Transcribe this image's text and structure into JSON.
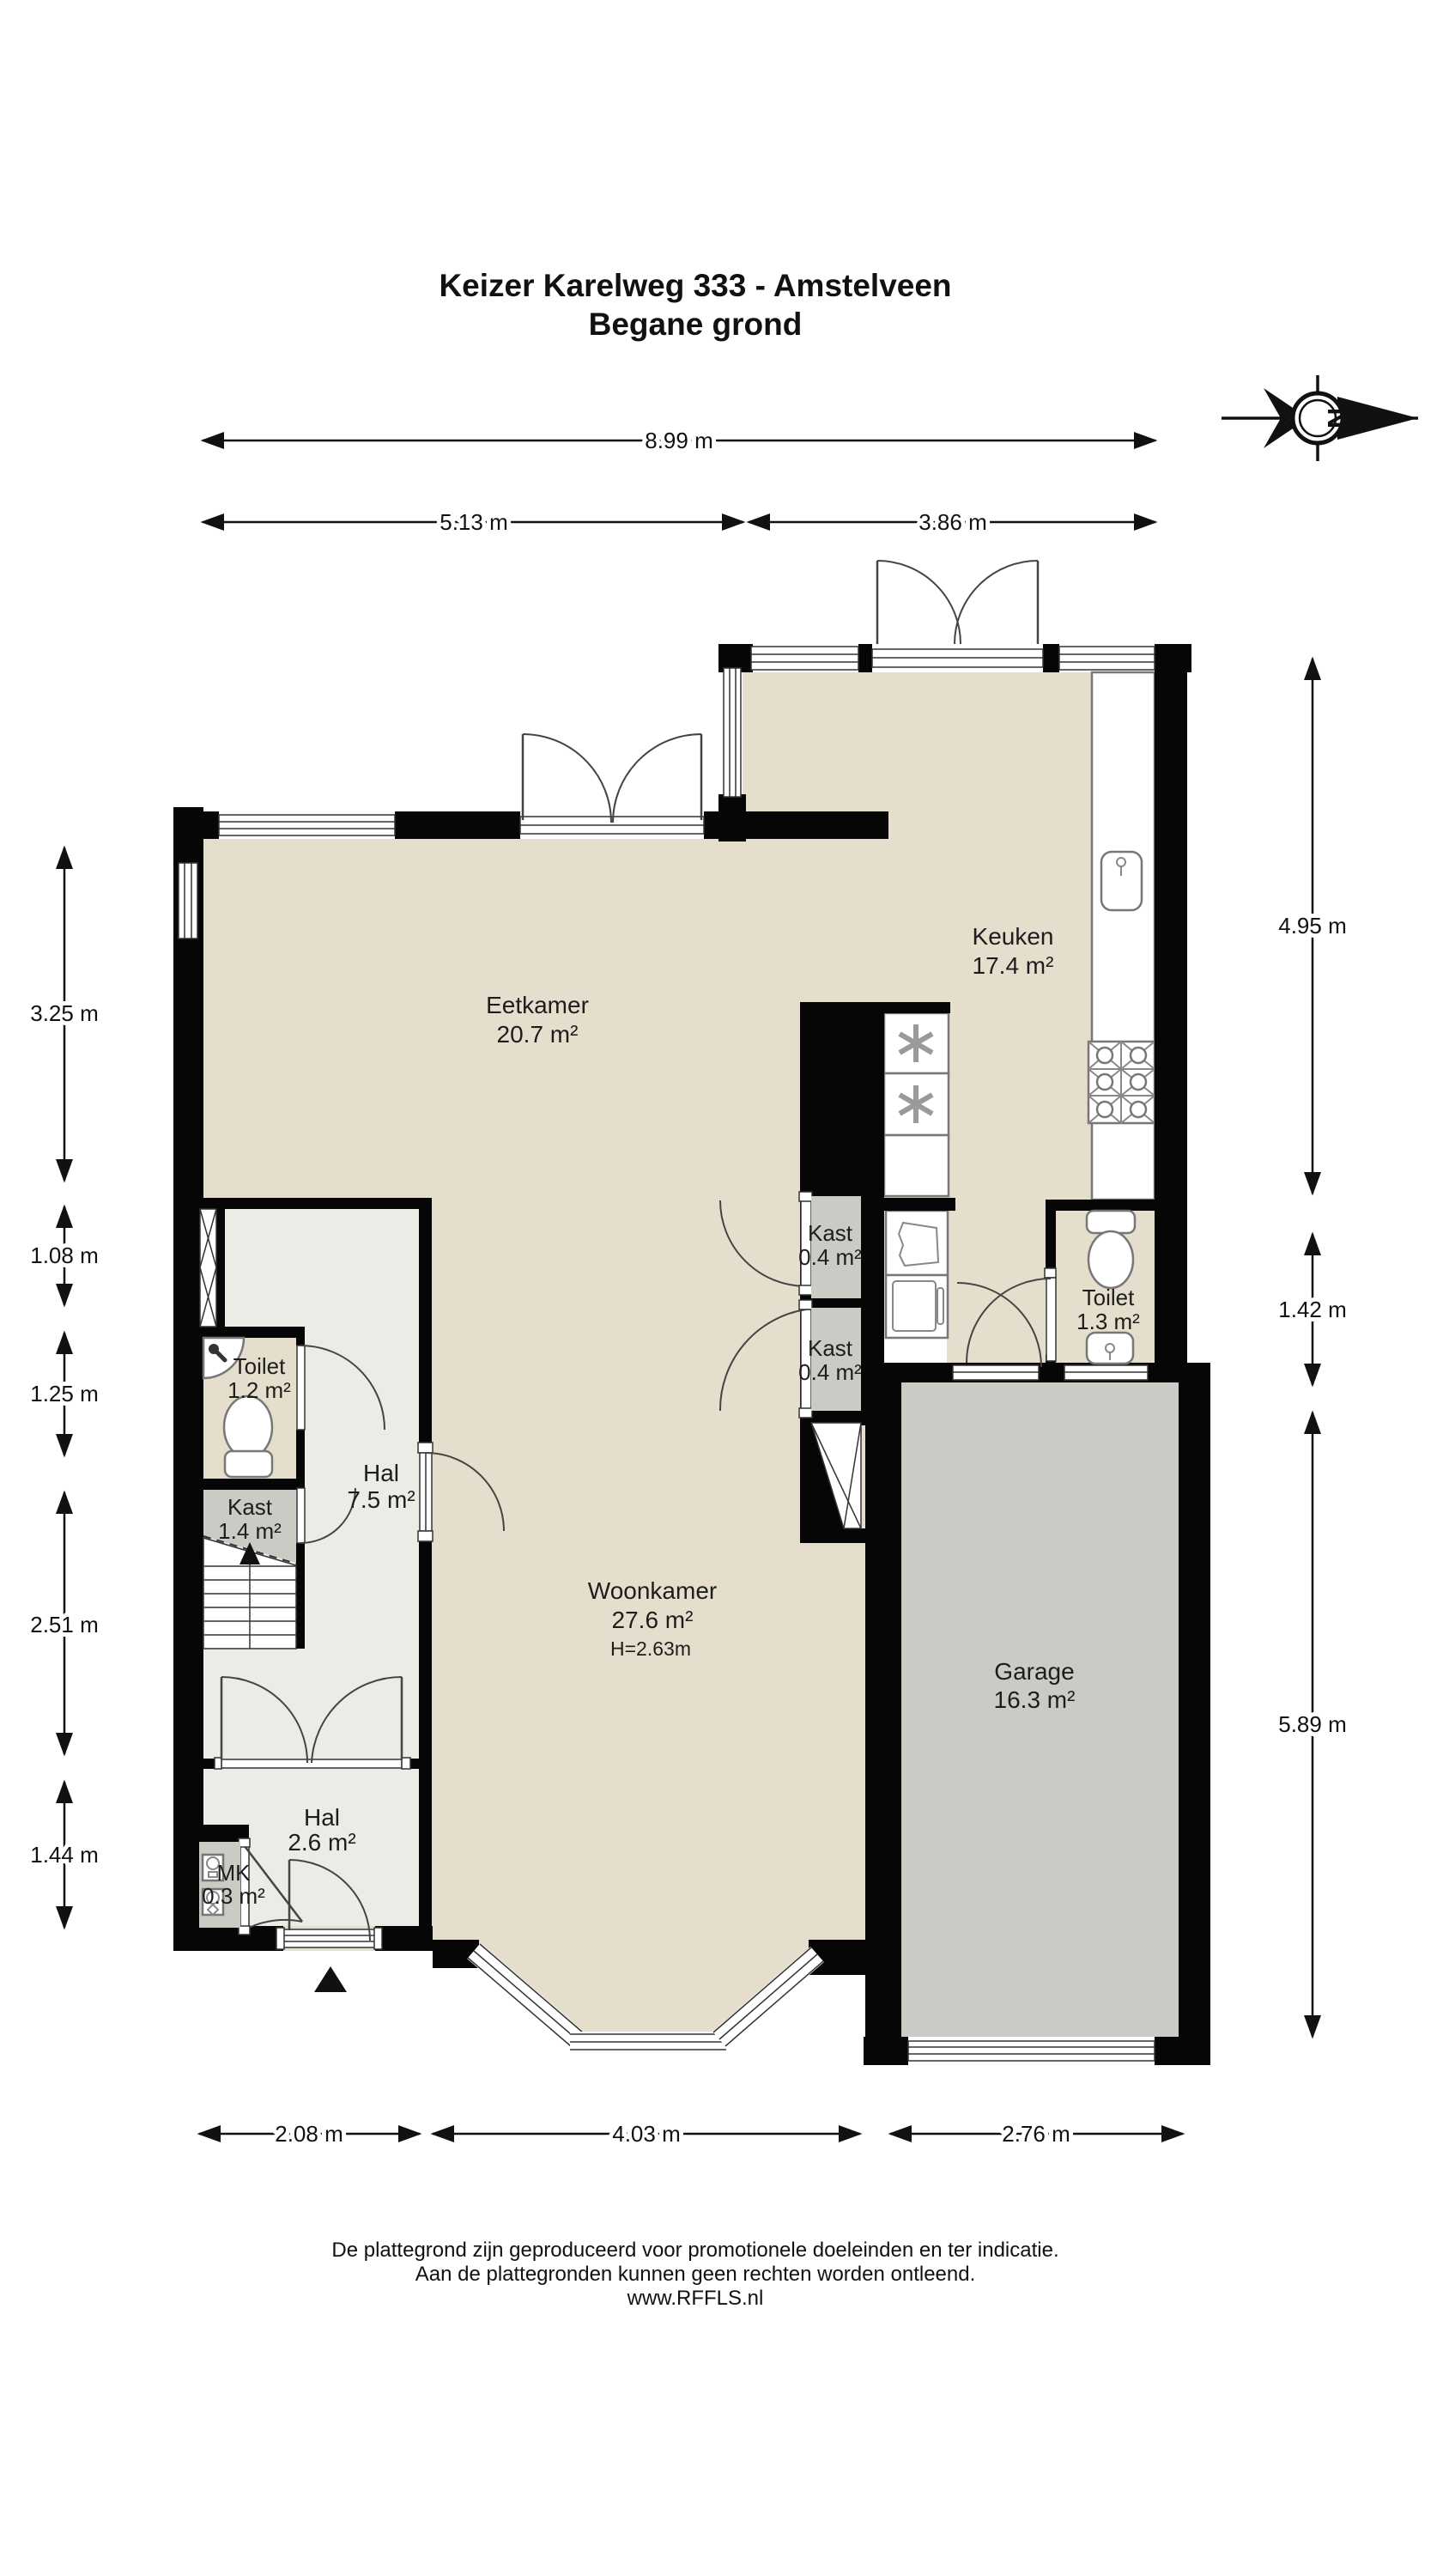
{
  "title": {
    "line1": "Keizer Karelweg 333 - Amstelveen",
    "line2": "Begane grond"
  },
  "compass": {
    "north_label": "N"
  },
  "rooms": {
    "eetkamer": {
      "name": "Eetkamer",
      "area": "20.7 m²"
    },
    "keuken": {
      "name": "Keuken",
      "area": "17.4 m²"
    },
    "kast_midden_boven": {
      "name": "Kast",
      "area": "0.4 m²"
    },
    "kast_midden_onder": {
      "name": "Kast",
      "area": "0.4 m²"
    },
    "toilet_keuken": {
      "name": "Toilet",
      "area": "1.3 m²"
    },
    "toilet_hal": {
      "name": "Toilet",
      "area": "1.2 m²"
    },
    "hal": {
      "name": "Hal",
      "area": "7.5 m²"
    },
    "kast_hal": {
      "name": "Kast",
      "area": "1.4 m²"
    },
    "woonkamer": {
      "name": "Woonkamer",
      "area": "27.6 m²",
      "ceiling_height": "H=2.63m"
    },
    "garage": {
      "name": "Garage",
      "area": "16.3 m²"
    },
    "hal_entree": {
      "name": "Hal",
      "area": "2.6 m²"
    },
    "meterkast": {
      "name": "MK",
      "area": "0.3 m²"
    }
  },
  "dimensions": {
    "top_total": "8.99 m",
    "top_left": "5.13 m",
    "top_right": "3.86 m",
    "left": [
      "3.25 m",
      "1.08 m",
      "1.25 m",
      "2.51 m",
      "1.44 m"
    ],
    "right": [
      "4.95 m",
      "1.42 m",
      "5.89 m"
    ],
    "bottom": [
      "2.08 m",
      "4.03 m",
      "2.76 m"
    ]
  },
  "footer": {
    "line1": "De plattegrond zijn geproduceerd voor promotionele doeleinden en ter indicatie.",
    "line2": "Aan de plattegronden kunnen geen rechten worden ontleend.",
    "line3": "www.RFFLS.nl"
  },
  "colors": {
    "floor_main": "#e6decc",
    "floor_hal": "#edebe5",
    "floor_gray": "#c9ccc4",
    "wall": "#060606"
  }
}
